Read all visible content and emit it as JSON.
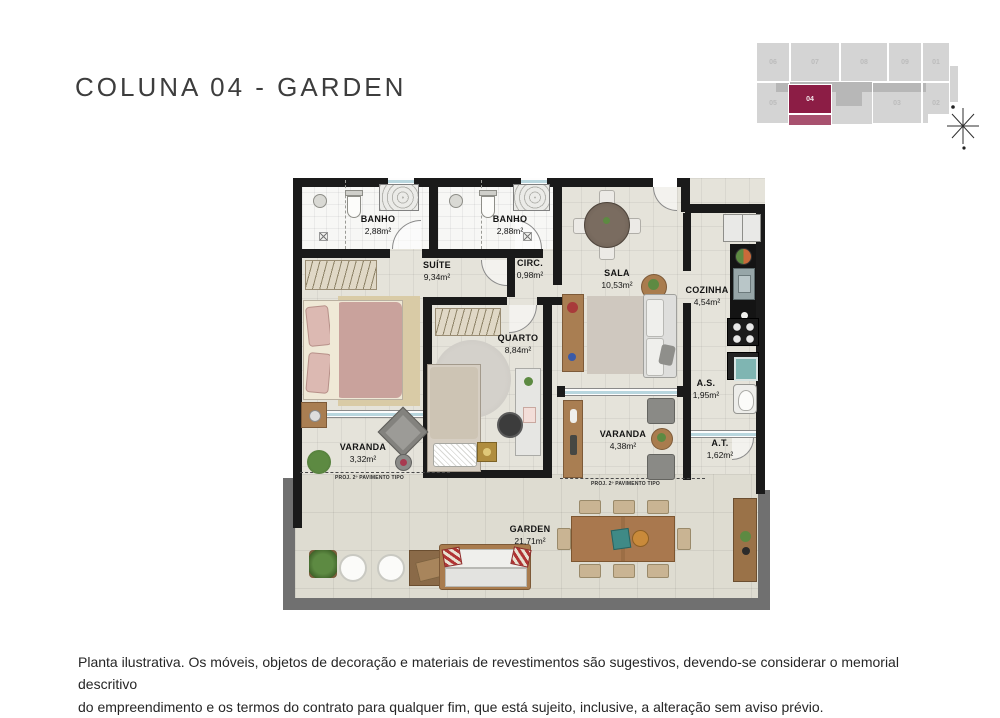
{
  "page": {
    "title": "COLUNA 04 - GARDEN"
  },
  "key_plan": {
    "units": {
      "u06": "06",
      "u07": "07",
      "u08": "08",
      "u09": "09",
      "u01": "01",
      "u05": "05",
      "u04": "04",
      "u03": "03",
      "u02": "02"
    },
    "highlighted_unit": "04",
    "colors": {
      "building": "#d4d4d4",
      "corridor": "#b7b7b7",
      "highlight": "#8c1d45",
      "highlight_strip": "#a8516f"
    }
  },
  "floor_plan": {
    "colors": {
      "wall": "#1a1a1a",
      "floor": "#e5e3da",
      "bath_floor": "#f7f7f5",
      "garden_floor": "#dedcd1",
      "garden_wall": "#707070",
      "window_glass": "#b8d6de"
    },
    "rooms": {
      "banho1": {
        "name": "BANHO",
        "area": "2,88m²"
      },
      "banho2": {
        "name": "BANHO",
        "area": "2,88m²"
      },
      "suite": {
        "name": "SUÍTE",
        "area": "9,34m²"
      },
      "circ": {
        "name": "CIRC.",
        "area": "0,98m²"
      },
      "sala": {
        "name": "SALA",
        "area": "10,53m²"
      },
      "cozinha": {
        "name": "COZINHA",
        "area": "4,54m²"
      },
      "quarto": {
        "name": "QUARTO",
        "area": "8,84m²"
      },
      "as": {
        "name": "A.S.",
        "area": "1,95m²"
      },
      "varanda_suite": {
        "name": "VARANDA",
        "area": "3,32m²"
      },
      "varanda_sala": {
        "name": "VARANDA",
        "area": "4,38m²"
      },
      "at": {
        "name": "A.T.",
        "area": "1,62m²"
      },
      "garden": {
        "name": "GARDEN",
        "area": "21,71m²"
      }
    },
    "annotations": {
      "proj_left": "PROJ. 2º PAVIMENTO TIPO",
      "proj_right": "PROJ. 2º PAVIMENTO TIPO"
    }
  },
  "disclaimer": {
    "line1": "Planta ilustrativa. Os móveis, objetos de decoração e materiais de revestimentos são sugestivos, devendo-se considerar o memorial descritivo",
    "line2": "do empreendimento e os termos do contrato para qualquer fim, que está sujeito, inclusive, a alteração sem aviso prévio."
  }
}
